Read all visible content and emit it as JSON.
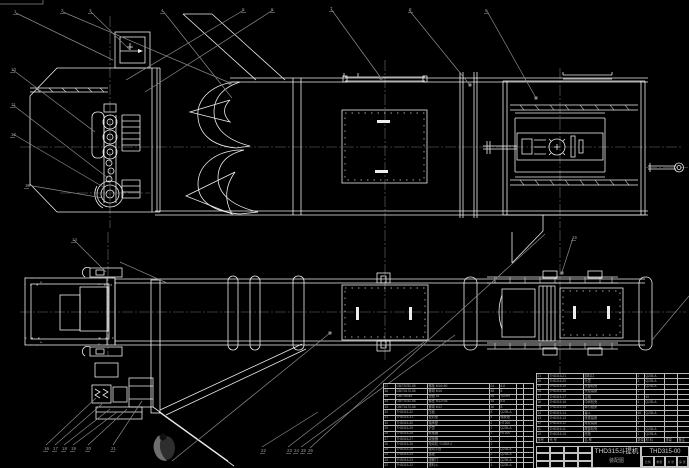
{
  "drawing": {
    "title": "THD315斗提机",
    "subtitle": "装配图",
    "number": "THD315-00",
    "title_block_fields": [
      "比例",
      "重量",
      "共 张",
      "第 张"
    ]
  },
  "bom": {
    "header": [
      "序号",
      "代  号",
      "名  称",
      "数量",
      "材  料",
      "重量",
      "备注"
    ],
    "left_rows": [
      [
        "37",
        "GB/T5782-86",
        "螺栓 M16×60",
        "24",
        "8.8",
        "",
        ""
      ],
      [
        "36",
        "GB/T6170-86",
        "螺母 M16",
        "48",
        "8",
        "",
        ""
      ],
      [
        "35",
        "GB/T95-85",
        "垫圈 16",
        "48",
        "100HV",
        "",
        ""
      ],
      [
        "34",
        "GB/T5782-86",
        "螺栓 M12×45",
        "36",
        "8.8",
        "",
        ""
      ],
      [
        "33",
        "GB/T6170-86",
        "螺母 M12",
        "36",
        "8",
        "",
        ""
      ],
      [
        "32",
        "THD315-32",
        "压板",
        "8",
        "Q235-A",
        "",
        ""
      ],
      [
        "31",
        "THD315-31",
        "密封垫",
        "4",
        "橡胶板",
        "",
        ""
      ],
      [
        "30",
        "THD315-30",
        "轴承座",
        "2",
        "HT200",
        "",
        ""
      ],
      [
        "29",
        "THD315-29",
        "护罩",
        "1",
        "Q235-A",
        "",
        ""
      ],
      [
        "28",
        "THD315-28",
        "联轴器",
        "1",
        "HT200",
        "",
        ""
      ],
      [
        "27",
        "THD315-27",
        "减速器",
        "1",
        "",
        "",
        ""
      ],
      [
        "26",
        "THD315-26",
        "电动机 Y132M-4",
        "1",
        "",
        "",
        ""
      ],
      [
        "25",
        "THD315-25",
        "驱动平台",
        "1",
        "Q235-A",
        "",
        ""
      ],
      [
        "24",
        "THD315-24",
        "盖板",
        "2",
        "Q235-A",
        "",
        ""
      ],
      [
        "23",
        "THD315-23",
        "观察门",
        "2",
        "Q235-A",
        "",
        ""
      ],
      [
        "22",
        "THD315-22",
        "进料斗",
        "1",
        "Q235-A",
        "",
        ""
      ]
    ],
    "right_rows": [
      [
        "21",
        "THD315-21",
        "卸料口",
        "1",
        "Q235-A",
        "",
        ""
      ],
      [
        "20",
        "THD315-20",
        "头罩",
        "1",
        "Q235-A",
        "",
        ""
      ],
      [
        "19",
        "THD315-19",
        "头部机壳",
        "1",
        "Q235-A",
        "",
        ""
      ],
      [
        "18",
        "THD315-18",
        "头轮装置",
        "1",
        "",
        "",
        ""
      ],
      [
        "17",
        "THD315-17",
        "主轴",
        "1",
        "45",
        "",
        ""
      ],
      [
        "16",
        "THD315-16",
        "中间机壳",
        "4",
        "Q235-A",
        "",
        ""
      ],
      [
        "15",
        "THD315-15",
        "牵引链条",
        "2",
        "",
        "",
        ""
      ],
      [
        "14",
        "THD315-14",
        "畚斗",
        "46",
        "Q235-A",
        "",
        ""
      ],
      [
        "13",
        "THD315-13",
        "张紧装置",
        "1",
        "",
        "",
        ""
      ],
      [
        "12",
        "THD315-12",
        "尾轮装置",
        "1",
        "",
        "",
        ""
      ],
      [
        "11",
        "THD315-11",
        "尾部机壳",
        "1",
        "Q235-A",
        "",
        ""
      ],
      [
        "10",
        "THD315-10",
        "底座",
        "1",
        "Q235-A",
        "",
        ""
      ]
    ]
  },
  "annotations": {
    "balloons": [
      {
        "x": 14,
        "y": 10,
        "label": "1"
      },
      {
        "x": 61,
        "y": 9,
        "label": "2"
      },
      {
        "x": 89,
        "y": 9,
        "label": "3"
      },
      {
        "x": 161,
        "y": 9,
        "label": "4"
      },
      {
        "x": 242,
        "y": 8,
        "label": "5"
      },
      {
        "x": 271,
        "y": 8,
        "label": "6"
      },
      {
        "x": 330,
        "y": 7,
        "label": "7"
      },
      {
        "x": 409,
        "y": 8,
        "label": "8"
      },
      {
        "x": 485,
        "y": 9,
        "label": "9"
      },
      {
        "x": 11,
        "y": 68,
        "label": "10"
      },
      {
        "x": 11,
        "y": 103,
        "label": "11"
      },
      {
        "x": 11,
        "y": 133,
        "label": "12"
      },
      {
        "x": 25,
        "y": 184,
        "label": "13"
      },
      {
        "x": 72,
        "y": 238,
        "label": "14"
      },
      {
        "x": 572,
        "y": 236,
        "label": "15"
      },
      {
        "x": 44,
        "y": 447,
        "label": "16"
      },
      {
        "x": 53,
        "y": 447,
        "label": "17"
      },
      {
        "x": 62,
        "y": 447,
        "label": "18"
      },
      {
        "x": 71,
        "y": 447,
        "label": "19"
      },
      {
        "x": 86,
        "y": 447,
        "label": "20"
      },
      {
        "x": 111,
        "y": 447,
        "label": "21"
      },
      {
        "x": 261,
        "y": 449,
        "label": "22"
      },
      {
        "x": 287,
        "y": 449,
        "label": "23"
      },
      {
        "x": 294,
        "y": 449,
        "label": "24"
      },
      {
        "x": 301,
        "y": 449,
        "label": "25"
      },
      {
        "x": 308,
        "y": 449,
        "label": "26"
      }
    ],
    "leaders": [
      [
        16,
        13,
        113,
        60
      ],
      [
        63,
        12,
        230,
        83
      ],
      [
        91,
        12,
        130,
        50
      ],
      [
        163,
        11,
        232,
        98
      ],
      [
        244,
        10,
        126,
        80
      ],
      [
        273,
        10,
        145,
        92
      ],
      [
        331,
        9,
        381,
        78
      ],
      [
        409,
        10,
        470,
        85
      ],
      [
        487,
        11,
        536,
        98
      ],
      [
        13,
        70,
        95,
        132
      ],
      [
        13,
        105,
        108,
        178
      ],
      [
        13,
        134,
        105,
        188
      ],
      [
        27,
        185,
        103,
        198
      ],
      [
        74,
        240,
        106,
        272
      ],
      [
        573,
        238,
        562,
        272
      ],
      [
        310,
        448,
        545,
        234
      ],
      [
        652,
        340,
        689,
        296
      ],
      [
        172,
        461,
        330,
        333
      ],
      [
        120,
        262,
        167,
        283
      ],
      [
        46,
        445,
        96,
        398
      ],
      [
        55,
        445,
        102,
        404
      ],
      [
        64,
        445,
        110,
        409
      ],
      [
        73,
        445,
        117,
        412
      ],
      [
        88,
        445,
        127,
        409
      ],
      [
        113,
        445,
        142,
        401
      ],
      [
        262,
        447,
        318,
        412
      ],
      [
        288,
        447,
        424,
        342
      ],
      [
        301,
        447,
        455,
        335
      ]
    ],
    "dots": [
      [
        381,
        78
      ],
      [
        536,
        98
      ],
      [
        330,
        333
      ],
      [
        562,
        273
      ],
      [
        230,
        83
      ],
      [
        470,
        85
      ]
    ]
  },
  "colors": {
    "background": "#000000",
    "line": "#ededed",
    "dim": "#8a8a8a",
    "table_text": "#a8a8a8"
  }
}
